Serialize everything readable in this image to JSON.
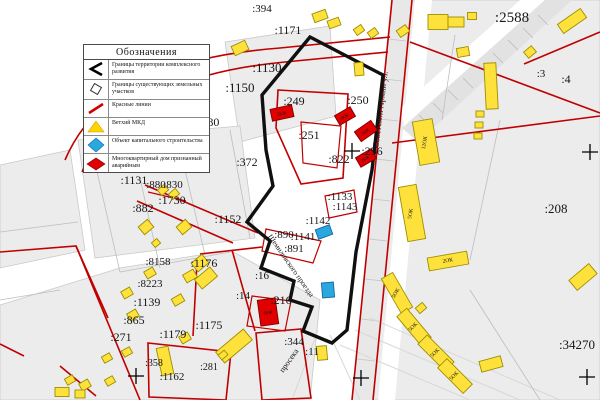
{
  "legend": {
    "title": "Обозначения",
    "items": [
      {
        "symbol": "development-boundary-line",
        "label": "Границы территории комплексного развития"
      },
      {
        "symbol": "existing-parcel-boundary",
        "label": "Границы существующих земельных участков"
      },
      {
        "symbol": "red-line",
        "label": "Красные линии"
      },
      {
        "symbol": "dilapidated-building-marker",
        "label": "Ветхий МКД"
      },
      {
        "symbol": "capital-construction-marker",
        "label": "Объект капитального строительства"
      },
      {
        "symbol": "emergency-building-marker",
        "label": "Многоквартирный дом признанный аварийным"
      }
    ]
  },
  "colors": {
    "building_yellow": "#ffe13b",
    "building_yellow_stroke": "#9c8f00",
    "building_red": "#e00000",
    "building_red_stroke": "#7d0000",
    "building_blue": "#29a8e0",
    "building_blue_stroke": "#1668a0",
    "red_line": "#c00000",
    "boundary_black": "#101010",
    "parcel_gray": "#ececec"
  },
  "map": {
    "parcel_labels": [
      {
        "t": ":394",
        "x": 262,
        "y": 12,
        "fs": 11
      },
      {
        "t": ":1171",
        "x": 288,
        "y": 34,
        "fs": 12
      },
      {
        "t": ":2588",
        "x": 512,
        "y": 22,
        "fs": 15
      },
      {
        "t": ":1130",
        "x": 267,
        "y": 72,
        "fs": 13
      },
      {
        "t": ":1150",
        "x": 240,
        "y": 92,
        "fs": 13
      },
      {
        "t": ":1180",
        "x": 206,
        "y": 126,
        "fs": 12
      },
      {
        "t": ":249",
        "x": 294,
        "y": 105,
        "fs": 12
      },
      {
        "t": ":250",
        "x": 358,
        "y": 104,
        "fs": 12
      },
      {
        "t": ":251",
        "x": 309,
        "y": 139,
        "fs": 12
      },
      {
        "t": ":822",
        "x": 339,
        "y": 163,
        "fs": 12
      },
      {
        "t": ":256",
        "x": 372,
        "y": 155,
        "fs": 12
      },
      {
        "t": ":3",
        "x": 541,
        "y": 77,
        "fs": 11
      },
      {
        "t": ":4",
        "x": 566,
        "y": 83,
        "fs": 12
      },
      {
        "t": ":372",
        "x": 247,
        "y": 166,
        "fs": 12
      },
      {
        "t": ":1131",
        "x": 134,
        "y": 184,
        "fs": 12
      },
      {
        "t": ":880",
        "x": 156,
        "y": 188,
        "fs": 11
      },
      {
        "t": ":830",
        "x": 173,
        "y": 188,
        "fs": 11
      },
      {
        "t": ":1730",
        "x": 172,
        "y": 204,
        "fs": 12
      },
      {
        "t": ":882",
        "x": 143,
        "y": 212,
        "fs": 12
      },
      {
        "t": ":1152",
        "x": 228,
        "y": 223,
        "fs": 12
      },
      {
        "t": ":208",
        "x": 556,
        "y": 213,
        "fs": 13
      },
      {
        "t": ":1133",
        "x": 340,
        "y": 200,
        "fs": 11
      },
      {
        "t": ":1143",
        "x": 345,
        "y": 210,
        "fs": 11
      },
      {
        "t": ":1142",
        "x": 318,
        "y": 224,
        "fs": 11
      },
      {
        "t": ":890",
        "x": 284,
        "y": 238,
        "fs": 11
      },
      {
        "t": ":1141",
        "x": 303,
        "y": 240,
        "fs": 11
      },
      {
        "t": ":891",
        "x": 294,
        "y": 252,
        "fs": 11
      },
      {
        "t": ":1176",
        "x": 204,
        "y": 267,
        "fs": 12
      },
      {
        "t": ":8158",
        "x": 158,
        "y": 265,
        "fs": 11
      },
      {
        "t": ":8223",
        "x": 150,
        "y": 287,
        "fs": 11
      },
      {
        "t": ":1139",
        "x": 147,
        "y": 306,
        "fs": 12
      },
      {
        "t": ":865",
        "x": 134,
        "y": 324,
        "fs": 12
      },
      {
        "t": ":271",
        "x": 121,
        "y": 341,
        "fs": 12
      },
      {
        "t": ":1179",
        "x": 173,
        "y": 338,
        "fs": 12
      },
      {
        "t": ":1175",
        "x": 209,
        "y": 329,
        "fs": 12
      },
      {
        "t": ":16",
        "x": 262,
        "y": 279,
        "fs": 11
      },
      {
        "t": ":14",
        "x": 243,
        "y": 299,
        "fs": 11
      },
      {
        "t": ":216",
        "x": 281,
        "y": 304,
        "fs": 12
      },
      {
        "t": ":358",
        "x": 154,
        "y": 366,
        "fs": 10
      },
      {
        "t": ":1162",
        "x": 172,
        "y": 380,
        "fs": 11
      },
      {
        "t": ":281",
        "x": 209,
        "y": 370,
        "fs": 10
      },
      {
        "t": ":344",
        "x": 294,
        "y": 345,
        "fs": 11
      },
      {
        "t": ":11",
        "x": 312,
        "y": 355,
        "fs": 11
      },
      {
        "t": ":34270",
        "x": 577,
        "y": 349,
        "fs": 13
      }
    ],
    "street_labels": [
      {
        "t": "Советской Армии ул.",
        "x": 383,
        "y": 110,
        "r": -83,
        "fs": 8.5
      },
      {
        "t": "Щемиловского проезда",
        "x": 289,
        "y": 267,
        "r": 55,
        "fs": 7.5
      },
      {
        "t": "просека",
        "x": 291,
        "y": 362,
        "r": -55,
        "fs": 8
      }
    ],
    "building_labels": [
      {
        "t": "12ОК",
        "x": 426,
        "y": 143,
        "r": -80
      },
      {
        "t": "5ОК",
        "x": 412,
        "y": 214,
        "r": -80
      },
      {
        "t": "2ОК",
        "x": 448,
        "y": 262,
        "r": -10
      },
      {
        "t": "5ОК",
        "x": 397,
        "y": 294,
        "r": -60
      },
      {
        "t": "5ОК",
        "x": 414,
        "y": 328,
        "r": -45
      },
      {
        "t": "5ОК",
        "x": 436,
        "y": 354,
        "r": -45
      },
      {
        "t": "5ОК",
        "x": 455,
        "y": 377,
        "r": -45
      },
      {
        "t": "284",
        "x": 197,
        "y": 133,
        "r": 0
      }
    ],
    "unit_labels": [
      {
        "t": "2КЖ",
        "x": 282,
        "y": 115,
        "r": -12
      },
      {
        "t": "2КЖ",
        "x": 345,
        "y": 118,
        "r": -30
      },
      {
        "t": "2КЖ",
        "x": 366,
        "y": 133,
        "r": -35
      },
      {
        "t": "2КЖ",
        "x": 366,
        "y": 160,
        "r": -30
      },
      {
        "t": "2КЖ",
        "x": 268,
        "y": 314,
        "r": -8
      }
    ],
    "grid_crosses": [
      {
        "x": 352,
        "y": 151
      },
      {
        "x": 590,
        "y": 152
      },
      {
        "x": 136,
        "y": 376
      },
      {
        "x": 361,
        "y": 378
      },
      {
        "x": 587,
        "y": 377
      }
    ],
    "buildings": {
      "yellow": [
        [
          240,
          48,
          15,
          10,
          -25
        ],
        [
          320,
          16,
          14,
          9,
          -20
        ],
        [
          334,
          23,
          12,
          8,
          -20
        ],
        [
          359,
          30,
          9,
          7,
          -35
        ],
        [
          373,
          33,
          9,
          7,
          -35
        ],
        [
          403,
          31,
          11,
          8,
          -35
        ],
        [
          438,
          22,
          20,
          15,
          0
        ],
        [
          456,
          22,
          16,
          10,
          0
        ],
        [
          472,
          16,
          9,
          7,
          0
        ],
        [
          572,
          21,
          28,
          11,
          -35
        ],
        [
          530,
          52,
          10,
          8,
          -40
        ],
        [
          463,
          52,
          12,
          9,
          -10
        ],
        [
          491,
          86,
          12,
          46,
          -3
        ],
        [
          359,
          69,
          9,
          13,
          -5
        ],
        [
          480,
          114,
          8,
          6,
          0
        ],
        [
          479,
          125,
          8,
          6,
          0
        ],
        [
          478,
          136,
          8,
          6,
          0
        ],
        [
          426,
          142,
          20,
          44,
          -10
        ],
        [
          412,
          213,
          18,
          55,
          -10
        ],
        [
          448,
          261,
          40,
          13,
          -10
        ],
        [
          397,
          293,
          13,
          40,
          -30
        ],
        [
          414,
          327,
          13,
          38,
          -40
        ],
        [
          436,
          353,
          13,
          38,
          -45
        ],
        [
          455,
          376,
          13,
          36,
          -45
        ],
        [
          421,
          308,
          9,
          7,
          -40
        ],
        [
          583,
          277,
          26,
          13,
          -40
        ],
        [
          491,
          364,
          22,
          11,
          -15
        ],
        [
          197,
          131,
          15,
          11,
          0
        ],
        [
          143,
          144,
          9,
          7,
          -25
        ],
        [
          163,
          190,
          9,
          7,
          -40
        ],
        [
          174,
          194,
          9,
          7,
          -40
        ],
        [
          146,
          227,
          12,
          10,
          -40
        ],
        [
          184,
          227,
          12,
          10,
          -40
        ],
        [
          156,
          243,
          7,
          6,
          -40
        ],
        [
          200,
          263,
          14,
          11,
          -40
        ],
        [
          206,
          278,
          20,
          12,
          -40
        ],
        [
          150,
          273,
          10,
          8,
          -30
        ],
        [
          190,
          276,
          12,
          9,
          -30
        ],
        [
          127,
          293,
          10,
          8,
          -30
        ],
        [
          178,
          300,
          11,
          8,
          -30
        ],
        [
          133,
          315,
          10,
          8,
          -30
        ],
        [
          185,
          338,
          10,
          8,
          -30
        ],
        [
          127,
          352,
          9,
          7,
          -30
        ],
        [
          107,
          358,
          9,
          7,
          -30
        ],
        [
          165,
          361,
          12,
          28,
          -12
        ],
        [
          85,
          385,
          10,
          8,
          -30
        ],
        [
          70,
          380,
          9,
          7,
          -30
        ],
        [
          110,
          381,
          9,
          7,
          -30
        ],
        [
          62,
          392,
          14,
          9,
          0
        ],
        [
          80,
          394,
          10,
          8,
          0
        ],
        [
          234,
          346,
          36,
          14,
          -40
        ],
        [
          223,
          355,
          8,
          6,
          -40
        ],
        [
          322,
          353,
          10,
          14,
          -5
        ]
      ],
      "red": [
        [
          282,
          113,
          22,
          12,
          -12
        ],
        [
          345,
          116,
          18,
          11,
          -30
        ],
        [
          366,
          131,
          20,
          12,
          -35
        ],
        [
          366,
          158,
          18,
          11,
          -30
        ],
        [
          268,
          312,
          18,
          26,
          -8
        ]
      ],
      "blue": [
        [
          324,
          232,
          15,
          10,
          -20
        ],
        [
          328,
          290,
          12,
          15,
          -5
        ]
      ]
    }
  }
}
